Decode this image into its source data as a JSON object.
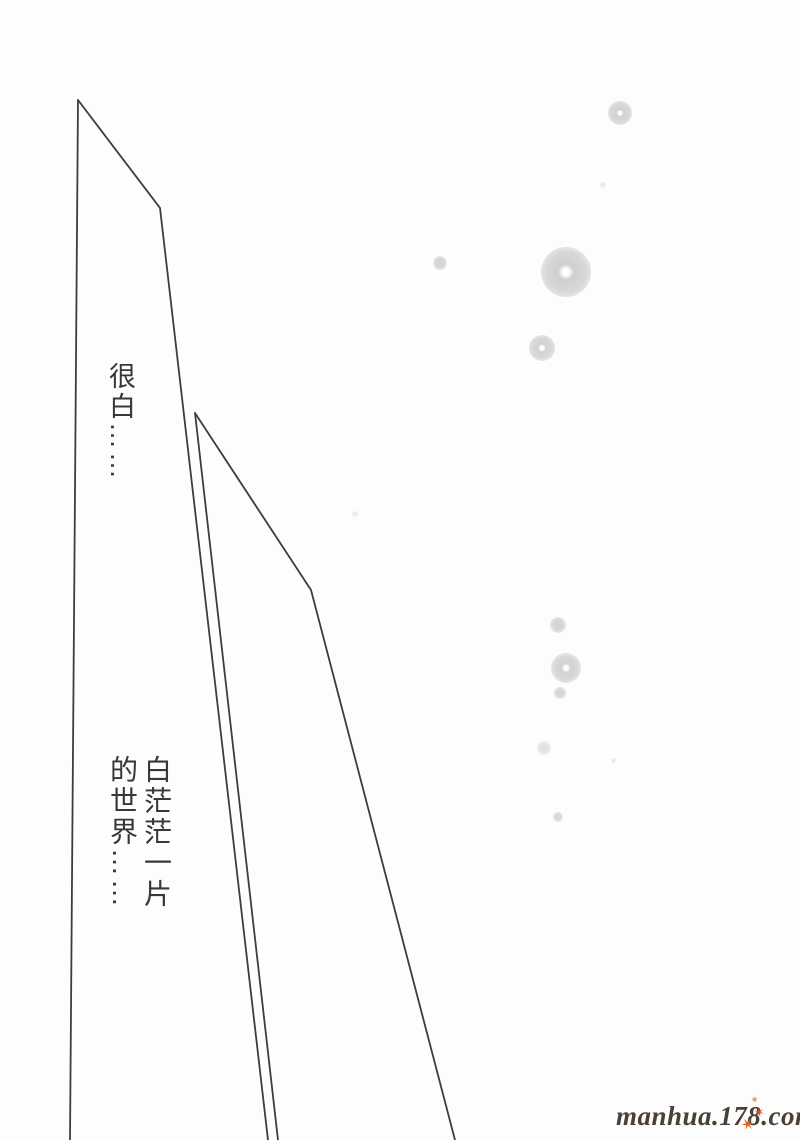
{
  "page": {
    "background": "#fdfdfd",
    "width": 800,
    "height": 1140
  },
  "artwork": {
    "line_color": "#3d3d3d",
    "line_width": 1.8,
    "speed_lines": [
      {
        "name": "left-beam-left-edge",
        "points": "78,100 70,1140"
      },
      {
        "name": "left-beam-right-edge",
        "points": "78,100 160,208 268,1140"
      },
      {
        "name": "mid-beam-left-edge",
        "points": "195,413 278,1140"
      },
      {
        "name": "mid-beam-right-edge",
        "points": "195,413 311,590 455,1140"
      }
    ],
    "halftone_dots": [
      {
        "x": 620,
        "y": 113,
        "r": 12,
        "hole": true,
        "opacity": 0.9
      },
      {
        "x": 603,
        "y": 185,
        "r": 3,
        "hole": false,
        "opacity": 0.4
      },
      {
        "x": 440,
        "y": 263,
        "r": 7,
        "hole": false,
        "opacity": 0.85
      },
      {
        "x": 566,
        "y": 272,
        "r": 25,
        "hole": true,
        "opacity": 0.95
      },
      {
        "x": 542,
        "y": 348,
        "r": 13,
        "hole": true,
        "opacity": 0.9
      },
      {
        "x": 355,
        "y": 514,
        "r": 3,
        "hole": false,
        "opacity": 0.4
      },
      {
        "x": 558,
        "y": 625,
        "r": 8,
        "hole": false,
        "opacity": 0.85
      },
      {
        "x": 566,
        "y": 668,
        "r": 15,
        "hole": true,
        "opacity": 0.9
      },
      {
        "x": 560,
        "y": 693,
        "r": 6,
        "hole": false,
        "opacity": 0.8
      },
      {
        "x": 544,
        "y": 748,
        "r": 7,
        "hole": false,
        "opacity": 0.55
      },
      {
        "x": 613,
        "y": 760,
        "r": 2.5,
        "hole": false,
        "opacity": 0.4
      },
      {
        "x": 558,
        "y": 817,
        "r": 5,
        "hole": false,
        "opacity": 0.75
      }
    ]
  },
  "dialogue": {
    "text_color": "#383838",
    "caption_1": "很白……",
    "caption_2": "白茫茫一片\n的世界……"
  },
  "watermark": {
    "text": "manhua.178.com",
    "color": "#4a4136",
    "stars": [
      {
        "char": "✶",
        "color": "#e8872a",
        "size": 10,
        "x": 750,
        "y": 1096,
        "rot": 15
      },
      {
        "char": "✶",
        "color": "#d9541d",
        "size": 13,
        "x": 754,
        "y": 1107,
        "rot": -12
      },
      {
        "char": "✶",
        "color": "#e0661e",
        "size": 17,
        "x": 740,
        "y": 1117,
        "rot": 22
      }
    ]
  }
}
